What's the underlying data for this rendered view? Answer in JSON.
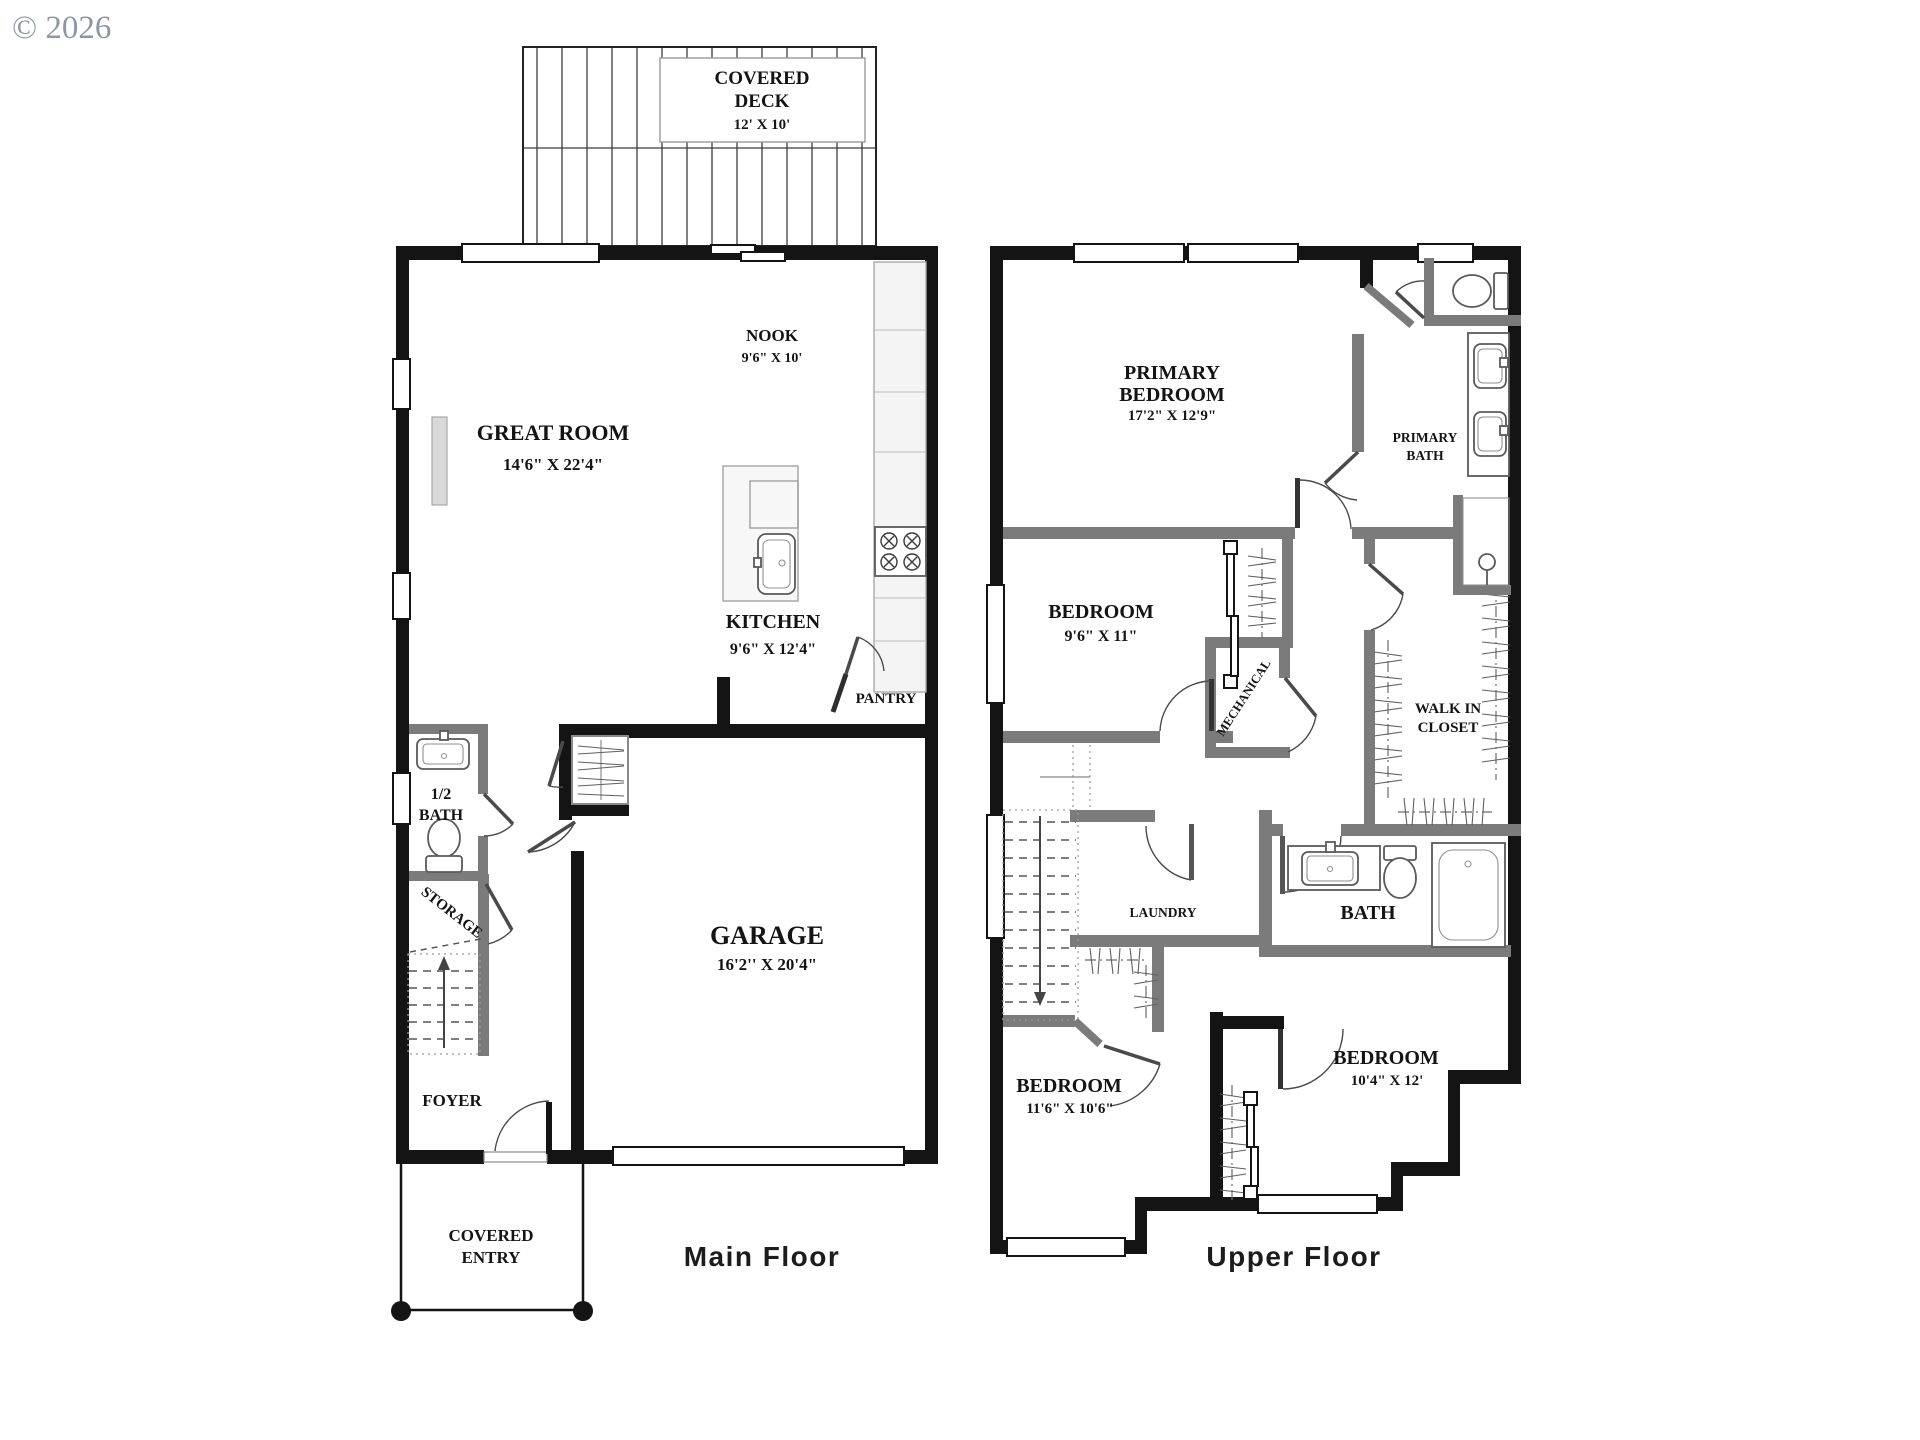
{
  "copyright": "© 2026",
  "floors": {
    "main": {
      "title": "Main Floor",
      "rooms": {
        "covered_deck": {
          "line1": "COVERED",
          "line2": "DECK",
          "dims": "12' X 10'"
        },
        "nook": {
          "name": "NOOK",
          "dims": "9'6\" X 10'"
        },
        "great_room": {
          "name": "GREAT ROOM",
          "dims": "14'6\" X 22'4\""
        },
        "kitchen": {
          "name": "KITCHEN",
          "dims": "9'6\" X 12'4\""
        },
        "pantry": {
          "name": "PANTRY"
        },
        "half_bath": {
          "line1": "1/2",
          "line2": "BATH"
        },
        "storage": {
          "name": "STORAGE"
        },
        "foyer": {
          "name": "FOYER"
        },
        "garage": {
          "name": "GARAGE",
          "dims": "16'2'' X  20'4\""
        },
        "covered_entry": {
          "line1": "COVERED",
          "line2": "ENTRY"
        }
      }
    },
    "upper": {
      "title": "Upper Floor",
      "rooms": {
        "primary_bedroom": {
          "line1": "PRIMARY",
          "line2": "BEDROOM",
          "dims": "17'2\" X 12'9\""
        },
        "primary_bath": {
          "line1": "PRIMARY",
          "line2": "BATH"
        },
        "bedroom_mid": {
          "name": "BEDROOM",
          "dims": "9'6\" X 11\""
        },
        "mechanical": {
          "name": "MECHANICAL"
        },
        "walk_in_closet": {
          "line1": "WALK IN",
          "line2": "CLOSET"
        },
        "laundry": {
          "name": "LAUNDRY"
        },
        "bath": {
          "name": "BATH"
        },
        "bedroom_left": {
          "name": "BEDROOM",
          "dims": "11'6\" X 10'6\""
        },
        "bedroom_right": {
          "name": "BEDROOM",
          "dims": "10'4\" X 12'"
        }
      }
    }
  }
}
